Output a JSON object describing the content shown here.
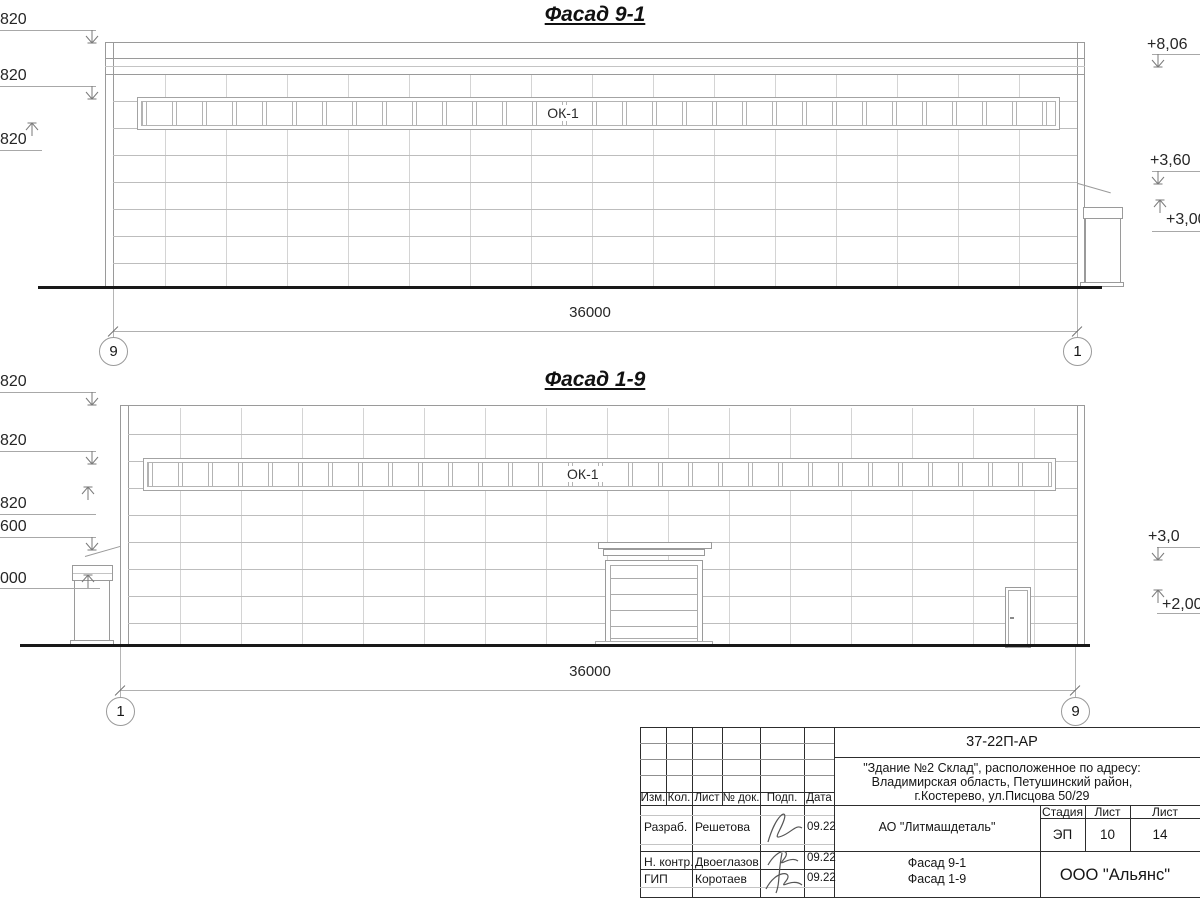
{
  "facade1": {
    "title": "Фасад 9-1",
    "window_label": "ОК-1",
    "dimension": "36000",
    "axis_left": "9",
    "axis_right": "1",
    "left_marks": [
      "820",
      "820",
      "820"
    ],
    "right_marks": [
      "+8,06",
      "+3,60",
      "+3,00"
    ]
  },
  "facade2": {
    "title": "Фасад 1-9",
    "window_label": "ОК-1",
    "dimension": "36000",
    "axis_left": "1",
    "axis_right": "9",
    "left_marks": [
      "820",
      "820",
      "820",
      "600",
      "000"
    ],
    "right_marks": [
      "+3,0",
      "+2,00"
    ]
  },
  "title_block": {
    "doc_number": "37-22П-АР",
    "project_address": [
      "\"Здание №2 Склад\", расположенное по адресу:",
      "Владимирская область, Петушинский район,",
      "г.Костерево, ул.Писцова 50/29"
    ],
    "header_cells": [
      "Изм.",
      "Кол.",
      "Лист",
      "№ док.",
      "Подп.",
      "Дата"
    ],
    "rows": [
      {
        "role": "Разраб.",
        "name": "Решетова",
        "date": "09.22"
      },
      {
        "role": "Н. контр.",
        "name": "Двоеглазов",
        "date": "09.22"
      },
      {
        "role": "ГИП",
        "name": "Коротаев",
        "date": "09.22"
      }
    ],
    "client": "АО \"Литмашдеталь\"",
    "stage_headers": [
      "Стадия",
      "Лист",
      "Лист"
    ],
    "stage": "ЭП",
    "sheet": "10",
    "sheets_total": "14",
    "sheet_title": [
      "Фасад 9-1",
      "Фасад 1-9"
    ],
    "company": "ООО \"Альянс\""
  }
}
